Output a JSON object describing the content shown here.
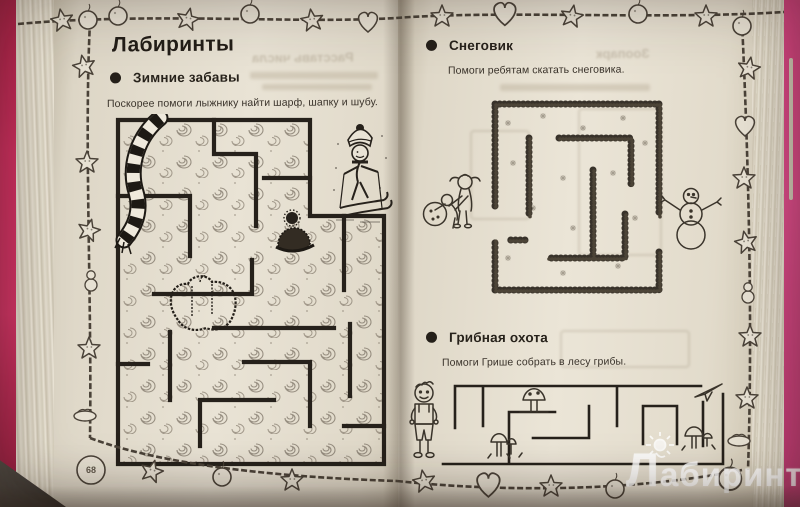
{
  "photo": {
    "type": "book-spread-photo",
    "watermark": {
      "text": "Лабиринт",
      "logo": "labirint-jester-icon",
      "color": "#ffffff"
    }
  },
  "book": {
    "left_page": {
      "page_number": "68",
      "title": "Лабиринты",
      "sections": [
        {
          "label": "Зимние забавы",
          "instruction": "Поскорее помоги лыжнику найти шарф, шапку и шубу.",
          "maze": "winter-swirl-maze",
          "figures": [
            "skier",
            "scarf",
            "hat",
            "fur-coat"
          ]
        }
      ],
      "show_through_text": "Расставь числа"
    },
    "right_page": {
      "sections": [
        {
          "label": "Снеговик",
          "instruction": "Помоги ребятам скатать снеговика.",
          "maze": "snow-maze",
          "figures": [
            "children-rolling-snowball",
            "snowman"
          ]
        },
        {
          "label": "Грибная охота",
          "instruction": "Помоги Грише собрать в лесу грибы.",
          "maze": "mushroom-maze",
          "figures": [
            "boy",
            "mushrooms",
            "paper-plane"
          ]
        }
      ],
      "show_through_text": "Зоопарк"
    },
    "border_ornaments": [
      "ball",
      "star",
      "heart",
      "snowman",
      "nest"
    ],
    "colors": {
      "cover_pink": "#c42a5e",
      "page_paper": "#e7e1d3",
      "ink": "#2a241d",
      "show_through": "#b7ac99"
    }
  }
}
